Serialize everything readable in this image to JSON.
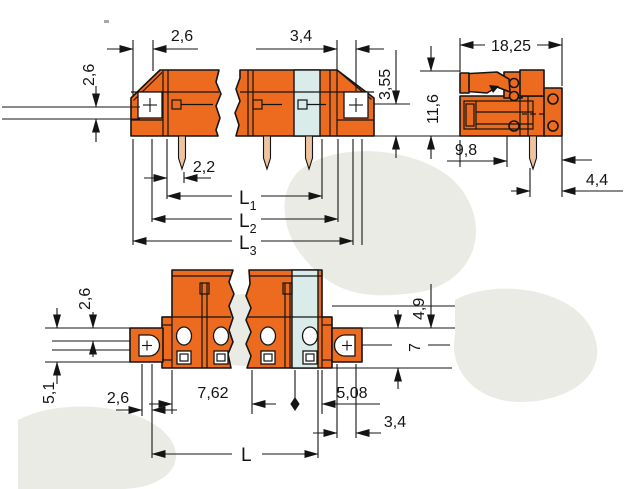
{
  "title": "Connector dimension drawing",
  "views": {
    "front": {
      "dims": {
        "top": "2,6",
        "left": "2,6",
        "top_right": "3,4",
        "right": "3,55",
        "pin": "2,2"
      },
      "lengths": [
        {
          "base": "L",
          "sub": "1"
        },
        {
          "base": "L",
          "sub": "2"
        },
        {
          "base": "L",
          "sub": "3"
        }
      ]
    },
    "side": {
      "dims": {
        "width": "18,25",
        "height": "11,6",
        "depth": "9,8",
        "pin_offset": "4,4"
      }
    },
    "plan": {
      "dims": {
        "step": "2,6",
        "left_height": "5,1",
        "flange_width": "2,6",
        "pitch": "7,62",
        "end_pitch": "5,08",
        "hole_offset": "3,4",
        "depth": "4,9",
        "flange_height": "7",
        "length": "L"
      }
    }
  },
  "colors": {
    "housing": "#ec6b1e",
    "insert": "#d9ece9",
    "pin": "#eec3a0",
    "line": "#141414",
    "dimline": "#141414",
    "watermark": "#ebebe6"
  }
}
